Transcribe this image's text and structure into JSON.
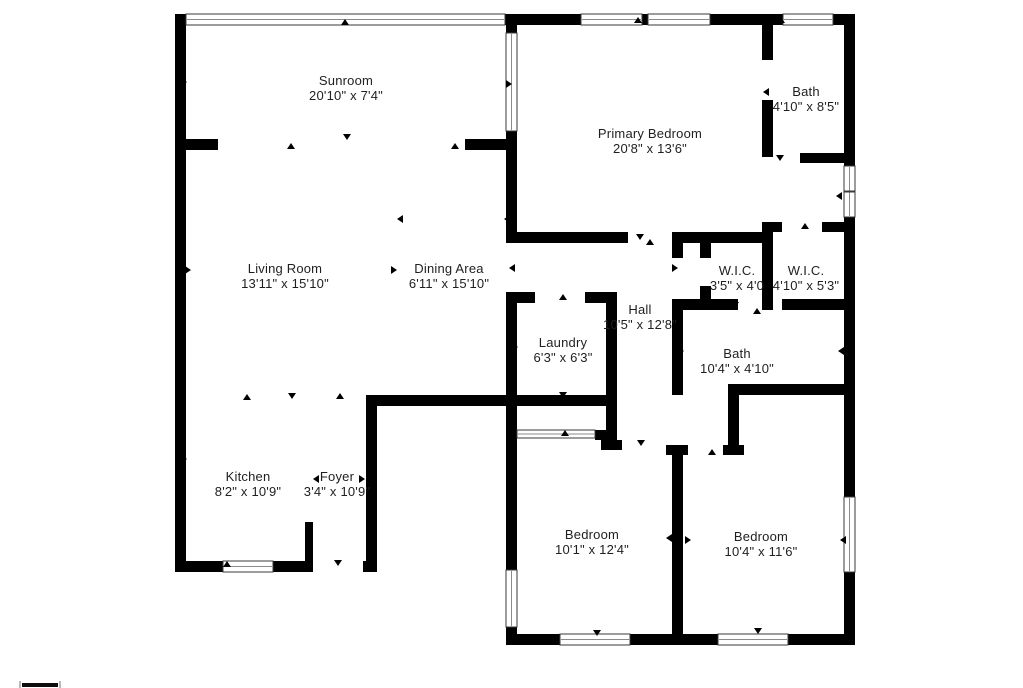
{
  "page": {
    "type": "floor-plan",
    "background": "#ffffff"
  },
  "colors": {
    "wall": "#000000",
    "text": "#1f1f1f",
    "window_border": "#3a3a3a",
    "window_line": "#8a8a8a",
    "tick": "#000000",
    "scale_bar": "#0d0d0d",
    "scale_mark": "#b9b9b9"
  },
  "canvas": {
    "width": 1023,
    "height": 688
  },
  "rooms": [
    {
      "id": "sunroom",
      "name": "Sunroom",
      "dimensions": "20'10\" x 7'4\"",
      "label_x": 346,
      "label_y": 88
    },
    {
      "id": "primary-bedroom",
      "name": "Primary Bedroom",
      "dimensions": "20'8\" x 13'6\"",
      "label_x": 650,
      "label_y": 141
    },
    {
      "id": "bath-top",
      "name": "Bath",
      "dimensions": "4'10\" x 8'5\"",
      "label_x": 806,
      "label_y": 99
    },
    {
      "id": "living-room",
      "name": "Living Room",
      "dimensions": "13'11\" x 15'10\"",
      "label_x": 285,
      "label_y": 276
    },
    {
      "id": "dining-area",
      "name": "Dining Area",
      "dimensions": "6'11\" x 15'10\"",
      "label_x": 449,
      "label_y": 276
    },
    {
      "id": "wic-left",
      "name": "W.I.C.",
      "dimensions": "3'5\" x 4'0",
      "label_x": 737,
      "label_y": 278
    },
    {
      "id": "wic-right",
      "name": "W.I.C.",
      "dimensions": "4'10\" x 5'3\"",
      "label_x": 806,
      "label_y": 278
    },
    {
      "id": "hall",
      "name": "Hall",
      "dimensions": "10'5\" x 12'8\"",
      "label_x": 640,
      "label_y": 317
    },
    {
      "id": "laundry",
      "name": "Laundry",
      "dimensions": "6'3\" x 6'3\"",
      "label_x": 563,
      "label_y": 350
    },
    {
      "id": "bath-middle",
      "name": "Bath",
      "dimensions": "10'4\" x 4'10\"",
      "label_x": 737,
      "label_y": 361
    },
    {
      "id": "kitchen",
      "name": "Kitchen",
      "dimensions": "8'2\" x 10'9\"",
      "label_x": 248,
      "label_y": 484
    },
    {
      "id": "foyer",
      "name": "Foyer",
      "dimensions": "3'4\" x 10'9\"",
      "label_x": 337,
      "label_y": 484
    },
    {
      "id": "bedroom-left",
      "name": "Bedroom",
      "dimensions": "10'1\" x 12'4\"",
      "label_x": 592,
      "label_y": 542
    },
    {
      "id": "bedroom-right",
      "name": "Bedroom",
      "dimensions": "10'4\" x 11'6\"",
      "label_x": 761,
      "label_y": 544
    }
  ],
  "walls": [
    [
      175,
      14,
      680,
      11
    ],
    [
      175,
      25,
      11,
      547
    ],
    [
      175,
      561,
      138,
      11
    ],
    [
      363,
      561,
      14,
      11
    ],
    [
      366,
      395,
      11,
      177
    ],
    [
      366,
      395,
      151,
      11
    ],
    [
      506,
      292,
      11,
      353
    ],
    [
      506,
      634,
      349,
      11
    ],
    [
      844,
      25,
      11,
      620
    ],
    [
      178,
      139,
      40,
      11
    ],
    [
      465,
      139,
      47,
      11
    ],
    [
      506,
      25,
      11,
      218
    ],
    [
      506,
      232,
      122,
      11
    ],
    [
      672,
      232,
      100,
      11
    ],
    [
      762,
      222,
      20,
      10
    ],
    [
      822,
      222,
      33,
      10
    ],
    [
      762,
      25,
      11,
      35
    ],
    [
      762,
      100,
      11,
      57
    ],
    [
      800,
      153,
      55,
      10
    ],
    [
      762,
      232,
      11,
      78
    ],
    [
      700,
      238,
      11,
      20
    ],
    [
      700,
      286,
      11,
      24
    ],
    [
      672,
      299,
      66,
      11
    ],
    [
      782,
      299,
      73,
      11
    ],
    [
      672,
      299,
      11,
      96
    ],
    [
      728,
      384,
      127,
      11
    ],
    [
      728,
      395,
      11,
      60
    ],
    [
      723,
      445,
      21,
      10
    ],
    [
      506,
      292,
      29,
      11
    ],
    [
      585,
      292,
      32,
      11
    ],
    [
      606,
      292,
      11,
      148
    ],
    [
      601,
      440,
      21,
      10
    ],
    [
      506,
      395,
      107,
      11
    ],
    [
      595,
      430,
      18,
      10
    ],
    [
      666,
      445,
      22,
      10
    ],
    [
      672,
      455,
      11,
      190
    ],
    [
      305,
      522,
      8,
      43
    ],
    [
      672,
      232,
      11,
      26
    ]
  ],
  "windows": [
    {
      "x": 186,
      "y": 14,
      "w": 319,
      "h": 11,
      "o": "h",
      "panes": 1
    },
    {
      "x": 581,
      "y": 14,
      "w": 61,
      "h": 11,
      "o": "h",
      "panes": 1
    },
    {
      "x": 648,
      "y": 14,
      "w": 62,
      "h": 11,
      "o": "h",
      "panes": 1
    },
    {
      "x": 783,
      "y": 14,
      "w": 50,
      "h": 11,
      "o": "h",
      "panes": 1
    },
    {
      "x": 506,
      "y": 33,
      "w": 11,
      "h": 98,
      "o": "v",
      "panes": 1
    },
    {
      "x": 844,
      "y": 166,
      "w": 11,
      "h": 51,
      "o": "v",
      "panes": 2
    },
    {
      "x": 844,
      "y": 497,
      "w": 11,
      "h": 75,
      "o": "v",
      "panes": 1
    },
    {
      "x": 506,
      "y": 570,
      "w": 11,
      "h": 57,
      "o": "v",
      "panes": 1
    },
    {
      "x": 223,
      "y": 561,
      "w": 50,
      "h": 11,
      "o": "h",
      "panes": 1
    },
    {
      "x": 560,
      "y": 634,
      "w": 70,
      "h": 11,
      "o": "h",
      "panes": 1
    },
    {
      "x": 718,
      "y": 634,
      "w": 70,
      "h": 11,
      "o": "h",
      "panes": 1
    },
    {
      "x": 517,
      "y": 430,
      "w": 78,
      "h": 8,
      "o": "h",
      "panes": 1
    }
  ],
  "door_ticks": [
    [
      345,
      22,
      "up"
    ],
    [
      638,
      20,
      "up"
    ],
    [
      781,
      20,
      "up"
    ],
    [
      291,
      146,
      "up"
    ],
    [
      455,
      146,
      "up"
    ],
    [
      347,
      137,
      "down"
    ],
    [
      184,
      82,
      "right"
    ],
    [
      509,
      84,
      "right"
    ],
    [
      188,
      270,
      "right"
    ],
    [
      400,
      219,
      "left"
    ],
    [
      394,
      270,
      "right"
    ],
    [
      512,
      268,
      "left"
    ],
    [
      511,
      196,
      "left"
    ],
    [
      507,
      219,
      "left"
    ],
    [
      640,
      237,
      "down"
    ],
    [
      650,
      242,
      "up"
    ],
    [
      766,
      92,
      "left"
    ],
    [
      780,
      158,
      "down"
    ],
    [
      805,
      226,
      "up"
    ],
    [
      675,
      268,
      "right"
    ],
    [
      735,
      305,
      "down"
    ],
    [
      757,
      311,
      "up"
    ],
    [
      681,
      351,
      "right"
    ],
    [
      841,
      351,
      "left"
    ],
    [
      515,
      347,
      "right"
    ],
    [
      610,
      341,
      "left"
    ],
    [
      563,
      297,
      "up"
    ],
    [
      565,
      433,
      "up"
    ],
    [
      563,
      395,
      "down"
    ],
    [
      247,
      397,
      "up"
    ],
    [
      292,
      396,
      "down"
    ],
    [
      340,
      396,
      "up"
    ],
    [
      184,
      459,
      "right"
    ],
    [
      316,
      479,
      "left"
    ],
    [
      362,
      479,
      "right"
    ],
    [
      227,
      564,
      "up"
    ],
    [
      338,
      563,
      "down"
    ],
    [
      514,
      538,
      "right"
    ],
    [
      669,
      538,
      "left"
    ],
    [
      688,
      540,
      "right"
    ],
    [
      843,
      540,
      "left"
    ],
    [
      597,
      633,
      "down"
    ],
    [
      758,
      631,
      "down"
    ],
    [
      641,
      443,
      "down"
    ],
    [
      712,
      452,
      "up"
    ],
    [
      839,
      196,
      "left"
    ]
  ],
  "scale_bar": {
    "x": 22,
    "y": 683,
    "w": 36,
    "h": 4
  }
}
